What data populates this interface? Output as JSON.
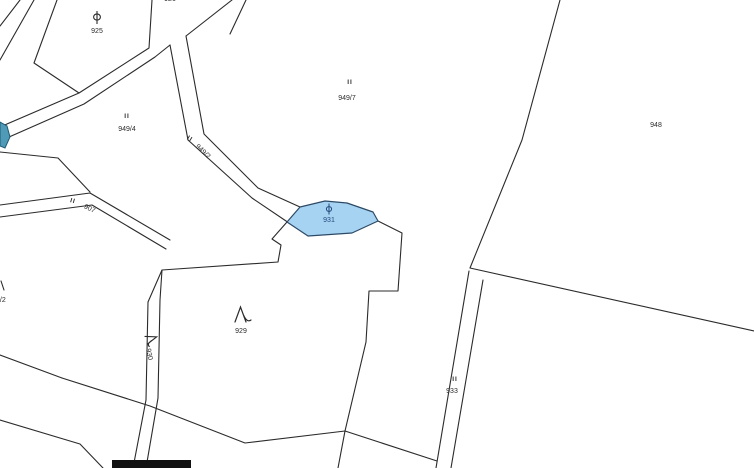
{
  "map": {
    "type": "cadastral-parcel-map",
    "colors": {
      "background": "#ffffff",
      "boundary_line": "#2b2b2b",
      "label_text": "#2b2b2b",
      "highlighted_parcel_fill": "#a7d3f2",
      "highlighted_parcel_stroke": "#2c4a66",
      "highlighted_parcel_text": "#23497c",
      "edge_parcel_fill": "#4f9ab7",
      "edge_parcel_stroke": "#1d5a73",
      "bottom_bar": "#111111"
    }
  },
  "symbols": {
    "grassland": "II",
    "orchard_icon_name": "orchard-icon",
    "tree_icon_name": "tree-icon"
  },
  "labels": {
    "p925": "925",
    "p926": "926",
    "p949_4": "949/4",
    "p949_2": "949/2",
    "p949_7": "949/7",
    "p948": "948",
    "p907": "907",
    "p931": "931",
    "p929": "929",
    "p930": "930",
    "p933": "933",
    "p9_2": "9/2"
  },
  "highlighted_parcel": {
    "id": "931",
    "state": "selected-blue"
  }
}
